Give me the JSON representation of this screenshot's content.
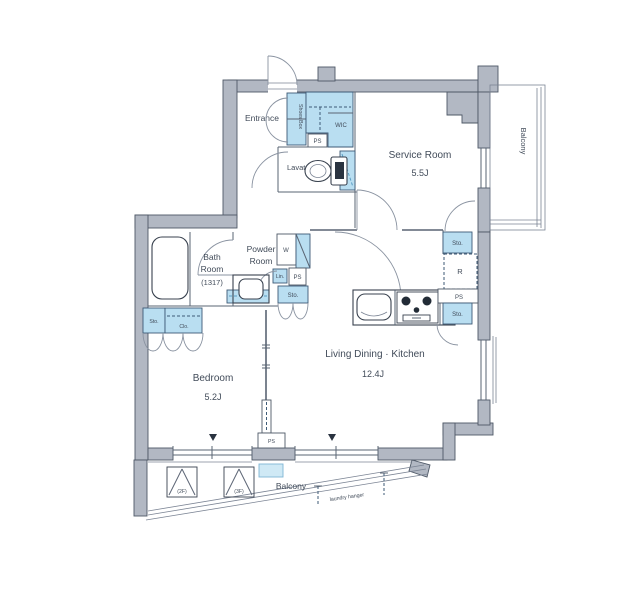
{
  "colors": {
    "wall_gray": "#b2b8c3",
    "fixture_blue": "#b9def1",
    "outline": "#4e5866",
    "text": "#414b59"
  },
  "rooms": {
    "entrance": {
      "label": "Entrance"
    },
    "shoes_box": {
      "label": "Shoes Box"
    },
    "wic": {
      "label": "WIC"
    },
    "lavatory": {
      "label": "Lavatory"
    },
    "service_room": {
      "label": "Service Room",
      "size": "5.5J"
    },
    "balcony_right": {
      "label": "Balcony"
    },
    "bath_room": {
      "line1": "Bath",
      "line2": "Room",
      "line3": "(1317)"
    },
    "powder_room": {
      "line1": "Powder",
      "line2": "Room"
    },
    "bedroom": {
      "label": "Bedroom",
      "size": "5.2J"
    },
    "ldk": {
      "label": "Living Dining · Kitchen",
      "size": "12.4J"
    },
    "balcony_bottom": {
      "label": "Balcony"
    }
  },
  "fixtures": {
    "ps_entrance": "PS",
    "ps_powder": "PS",
    "ps_kitchen": "PS",
    "ps_partition": "PS",
    "washer": "W",
    "linen": "Lin.",
    "sto_powder": "Sto.",
    "sto_closet": "Sto.",
    "closet": "Clo.",
    "sto_kitchen_top": "Sto.",
    "sto_kitchen_bottom": "Sto.",
    "fridge": "R",
    "hatch_2f": "(2F)",
    "hatch_3f": "(3F)",
    "laundry_hanger": "laundry hanger"
  }
}
